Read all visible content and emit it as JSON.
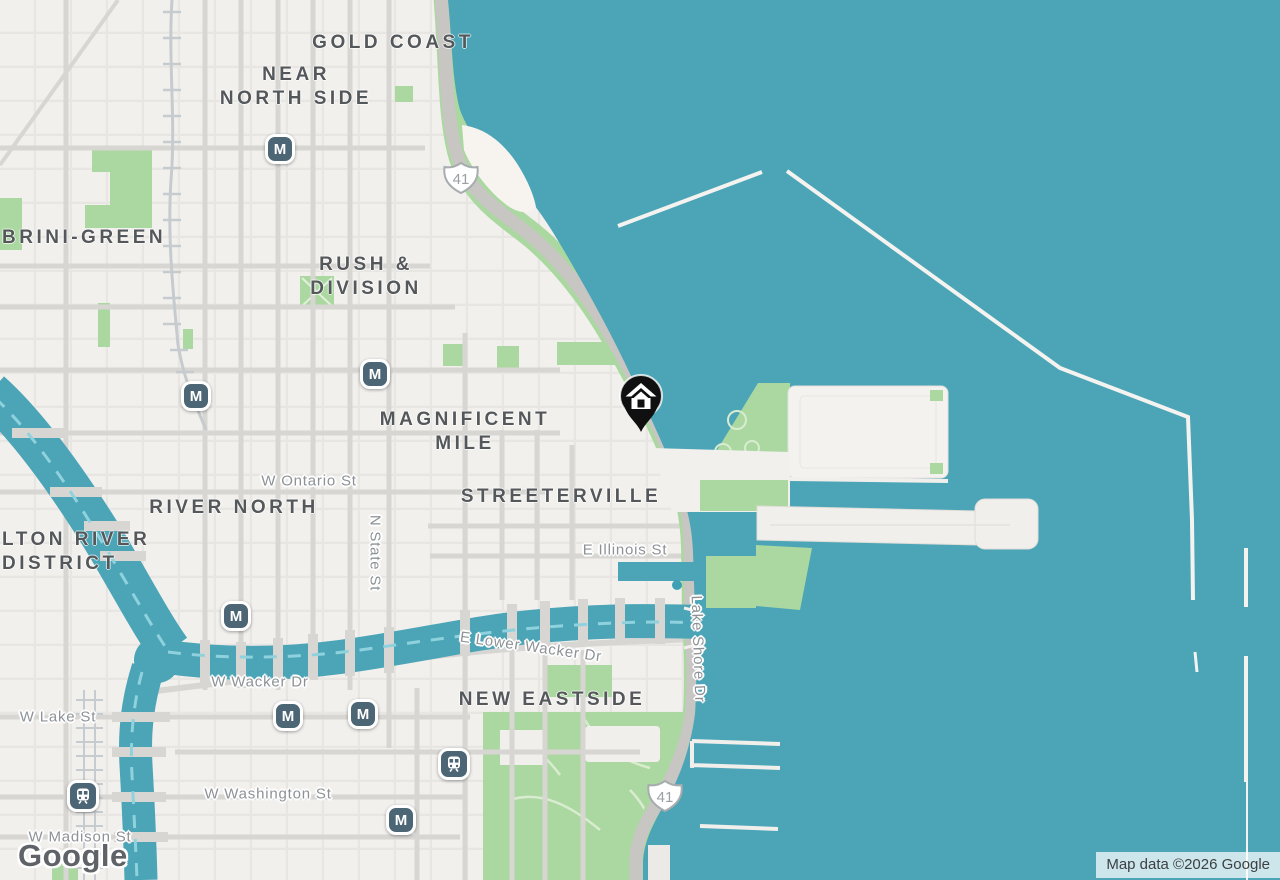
{
  "colors": {
    "water": "#4ba5b7",
    "land": "#f2f0ed",
    "park": "#abd8a1",
    "road": "#d8d6d3",
    "road-major": "#c8c6c3",
    "transit": "#4d6675",
    "label-dark": "#54585b",
    "label-street": "#8d9296",
    "marker": "#101010",
    "river-dash": "#8fd2de"
  },
  "map": {
    "logo_text": "Google",
    "attribution": "Map data ©2026 Google",
    "icons": {
      "metro_glyph": "M",
      "train_icon": "train-front",
      "marker_icon": "home"
    },
    "route_shields": [
      {
        "number": "41"
      },
      {
        "number": "41"
      }
    ],
    "neighborhoods": [
      {
        "id": "gold-coast",
        "lines": [
          "GOLD COAST"
        ]
      },
      {
        "id": "near-north-side",
        "lines": [
          "NEAR",
          "NORTH SIDE"
        ]
      },
      {
        "id": "cabrini-green",
        "lines": [
          "BRINI-GREEN"
        ]
      },
      {
        "id": "rush-and-division",
        "lines": [
          "RUSH &",
          "DIVISION"
        ]
      },
      {
        "id": "magnificent-mile",
        "lines": [
          "MAGNIFICENT",
          "MILE"
        ]
      },
      {
        "id": "river-north",
        "lines": [
          "RIVER NORTH"
        ]
      },
      {
        "id": "fulton-river-district",
        "lines": [
          "LTON RIVER",
          "DISTRICT"
        ]
      },
      {
        "id": "streeterville",
        "lines": [
          "STREETERVILLE"
        ]
      },
      {
        "id": "new-eastside",
        "lines": [
          "NEW EASTSIDE"
        ]
      }
    ],
    "streets": [
      {
        "id": "w-ontario-st",
        "text": "W Ontario St"
      },
      {
        "id": "n-state-st",
        "text": "N State St"
      },
      {
        "id": "e-illinois-st",
        "text": "E Illinois St"
      },
      {
        "id": "e-lower-wacker-dr",
        "text": "E Lower Wacker Dr"
      },
      {
        "id": "w-wacker-dr",
        "text": "W Wacker Dr"
      },
      {
        "id": "w-lake-st",
        "text": "W Lake St"
      },
      {
        "id": "w-washington-st",
        "text": "W Washington St"
      },
      {
        "id": "w-madison-st",
        "text": "W Madison St"
      },
      {
        "id": "lake-shore-dr",
        "text": "Lake Shore Dr"
      }
    ]
  }
}
